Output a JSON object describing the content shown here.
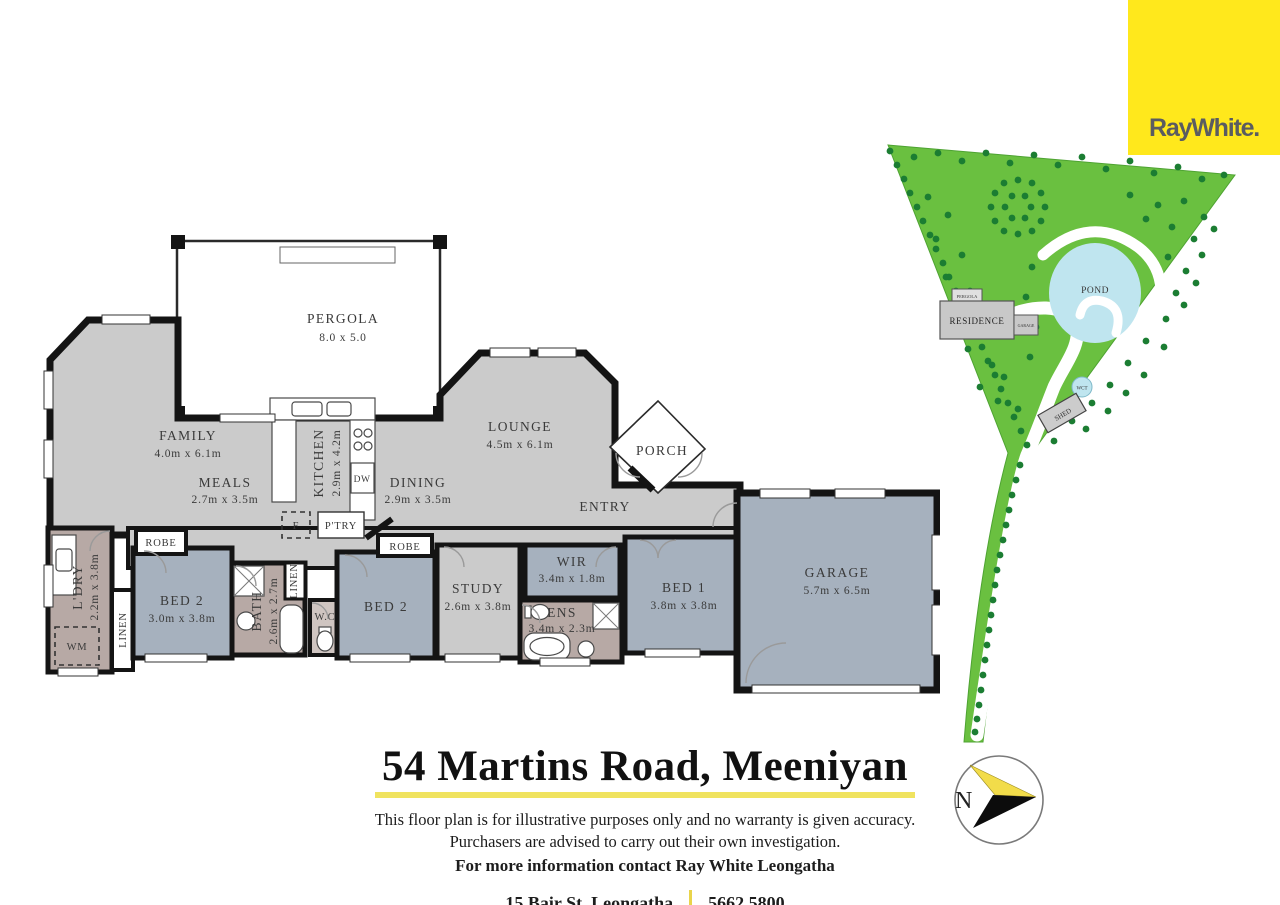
{
  "logo": {
    "text": "RayWhite.",
    "bg_color": "#FFE81C",
    "text_color": "#5A5C61"
  },
  "title_block": {
    "title": "54 Martins Road, Meeniyan",
    "underline_color": "#F0E35F",
    "disclaimer_line1": "This floor plan is for illustrative purposes only and no warranty is given accuracy.",
    "disclaimer_line2": "Purchasers are advised to carry out their own investigation.",
    "contact_line": "For more information contact Ray White Leongatha",
    "address": "15 Bair St, Leongatha",
    "phone": "5662 5800"
  },
  "compass": {
    "north_label": "N",
    "arrow_yellow": "#F2DC4A",
    "arrow_black": "#0c0c0c"
  },
  "floor_plan": {
    "colors": {
      "living": "#CBCBCB",
      "bedroom": "#A6B1BE",
      "wet": "#B7A9A5",
      "wall": "#141414"
    },
    "rooms": [
      {
        "name": "PERGOLA",
        "dims": "8.0 x 5.0"
      },
      {
        "name": "FAMILY",
        "dims": "4.0m x 6.1m"
      },
      {
        "name": "MEALS",
        "dims": "2.7m x 3.5m"
      },
      {
        "name": "KITCHEN",
        "dims": "2.9m x 4.2m"
      },
      {
        "name": "LOUNGE",
        "dims": "4.5m x 6.1m"
      },
      {
        "name": "DINING",
        "dims": "2.9m x 3.5m"
      },
      {
        "name": "PORCH"
      },
      {
        "name": "ENTRY"
      },
      {
        "name": "GARAGE",
        "dims": "5.7m x 6.5m"
      },
      {
        "name": "BED 1",
        "dims": "3.8m x 3.8m"
      },
      {
        "name": "WIR",
        "dims": "3.4m x 1.8m"
      },
      {
        "name": "ENS",
        "dims": "3.4m x 2.3m"
      },
      {
        "name": "STUDY",
        "dims": "2.6m x 3.8m"
      },
      {
        "name": "BED 2"
      },
      {
        "name": "BED 2",
        "dims": "3.0m x 3.8m"
      },
      {
        "name": "L'DRY",
        "dims": "2.2m x 3.8m"
      },
      {
        "name": "BATH",
        "dims": "2.6m x 2.7m"
      }
    ],
    "small_labels": {
      "robe_left": "ROBE",
      "robe_mid": "ROBE",
      "linen_left": "LINEN",
      "linen_bath": "LINEN",
      "wc": "W.C",
      "wm": "WM",
      "fridge": "F",
      "pantry": "P'TRY",
      "dw": "DW"
    }
  },
  "site_plan": {
    "colors": {
      "grass": "#6AC040",
      "tree": "#1B7D32",
      "water": "#BFE5EF",
      "building": "#C8C8C8"
    },
    "labels": {
      "residence": "RESIDENCE",
      "pergola": "PERGOLA",
      "garage": "GARAGE",
      "pond": "POND",
      "wct": "WCT",
      "shed": "SHED"
    }
  }
}
